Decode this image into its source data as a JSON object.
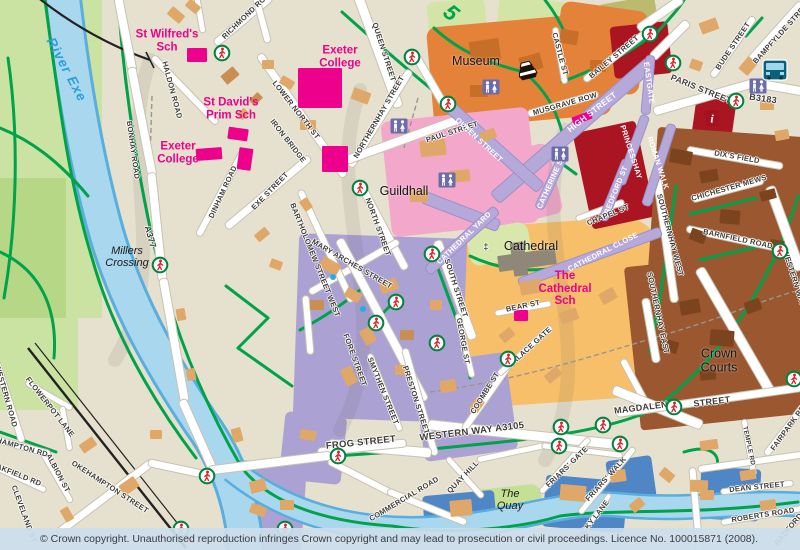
{
  "attribution": {
    "text": "© Crown copyright. Unauthorised reproduction infringes Crown copyright and may lead to prosecution or civil proceedings. Licence No. 100015871 (2008)."
  },
  "map": {
    "street_labels": [
      {
        "id": "queen-street-n",
        "text": "QUEEN STREET",
        "x": 384,
        "y": 52,
        "r": 72
      },
      {
        "id": "richmond-road",
        "text": "RICHMOND ROAD",
        "x": 248,
        "y": 14,
        "r": -44
      },
      {
        "id": "haldon-road",
        "text": "HALDON ROAD",
        "x": 172,
        "y": 90,
        "r": 75
      },
      {
        "id": "bonhay-road",
        "text": "BONHAY ROAD",
        "x": 133,
        "y": 150,
        "r": 82
      },
      {
        "id": "a377",
        "text": "A377",
        "x": 150,
        "y": 237,
        "r": 75,
        "s": 9
      },
      {
        "id": "lower-north-st",
        "text": "LOWER NORTH ST",
        "x": 296,
        "y": 110,
        "r": 52
      },
      {
        "id": "iron-bridge",
        "text": "IRON BRIDGE",
        "x": 288,
        "y": 141,
        "r": 52
      },
      {
        "id": "northernhay-street",
        "text": "NORTHERNHAY STREET",
        "x": 379,
        "y": 117,
        "r": -60
      },
      {
        "id": "paul-street",
        "text": "PAUL STREET",
        "x": 452,
        "y": 132,
        "r": -18
      },
      {
        "id": "queen-street-ped",
        "text": "QUEEN STREET",
        "x": 479,
        "y": 140,
        "r": 43,
        "v": "w"
      },
      {
        "id": "musgrave-row",
        "text": "MUSGRAVE ROW",
        "x": 565,
        "y": 104,
        "r": -16
      },
      {
        "id": "castle-st",
        "text": "CASTLE ST",
        "x": 560,
        "y": 54,
        "r": 75
      },
      {
        "id": "bailey-street",
        "text": "BAILEY STREET",
        "x": 614,
        "y": 57,
        "r": -40
      },
      {
        "id": "high-street",
        "text": "HIGH STREET",
        "x": 592,
        "y": 112,
        "r": -38,
        "v": "w",
        "s": 8.5
      },
      {
        "id": "eastgate",
        "text": "EASTGATE",
        "x": 649,
        "y": 83,
        "r": 82,
        "v": "w"
      },
      {
        "id": "princesshay",
        "text": "PRINCESSHAY",
        "x": 631,
        "y": 152,
        "r": 72,
        "v": "w"
      },
      {
        "id": "roman-walk",
        "text": "ROMAN WALK",
        "x": 658,
        "y": 163,
        "r": 72,
        "v": "w"
      },
      {
        "id": "catherine-st",
        "text": "CATHERINE ST",
        "x": 551,
        "y": 182,
        "r": -66,
        "v": "w"
      },
      {
        "id": "bedford-st",
        "text": "BEDFORD ST",
        "x": 616,
        "y": 190,
        "r": -68,
        "v": "w"
      },
      {
        "id": "chapel-st",
        "text": "CHAPEL ST",
        "x": 608,
        "y": 215,
        "r": -22
      },
      {
        "id": "paris-street",
        "text": "PARIS STREET",
        "x": 701,
        "y": 89,
        "r": 22,
        "s": 8.5
      },
      {
        "id": "b3183",
        "text": "B3183",
        "x": 763,
        "y": 99,
        "r": 8,
        "s": 9
      },
      {
        "id": "bude-street",
        "text": "BUDE STREET",
        "x": 733,
        "y": 46,
        "r": -56
      },
      {
        "id": "bampfylde-street",
        "text": "BAMPFYLDE STREET",
        "x": 782,
        "y": 32,
        "r": -48
      },
      {
        "id": "dixs-field",
        "text": "DIX'S FIELD",
        "x": 737,
        "y": 157,
        "r": 10
      },
      {
        "id": "chichester-mews",
        "text": "CHICHESTER MEWS",
        "x": 729,
        "y": 188,
        "r": -16
      },
      {
        "id": "barnfield-road",
        "text": "BARNFIELD ROAD",
        "x": 738,
        "y": 239,
        "r": 12
      },
      {
        "id": "southernhay-west",
        "text": "SOUTHERNHAY WEST",
        "x": 670,
        "y": 235,
        "r": 75
      },
      {
        "id": "southernhay-east",
        "text": "SOUTHERNHAY EAST",
        "x": 658,
        "y": 313,
        "r": 78
      },
      {
        "id": "cathedral-yard",
        "text": "CATHEDRAL YARD",
        "x": 464,
        "y": 238,
        "r": -44,
        "v": "w"
      },
      {
        "id": "cathedral-close",
        "text": "CATHEDRAL CLOSE",
        "x": 603,
        "y": 252,
        "r": -27,
        "v": "w"
      },
      {
        "id": "north-street",
        "text": "NORTH STREET",
        "x": 378,
        "y": 227,
        "r": 70
      },
      {
        "id": "mary-arches-street",
        "text": "MARY ARCHES STREET",
        "x": 352,
        "y": 264,
        "r": 30
      },
      {
        "id": "bartholomew-street-west",
        "text": "BARTHOLOMEW STREET WEST",
        "x": 315,
        "y": 260,
        "r": 68
      },
      {
        "id": "south-street",
        "text": "SOUTH STREET",
        "x": 456,
        "y": 288,
        "r": 72
      },
      {
        "id": "george-st",
        "text": "GEORGE ST",
        "x": 463,
        "y": 341,
        "r": 80
      },
      {
        "id": "fore-street",
        "text": "FORE STREET",
        "x": 355,
        "y": 360,
        "r": 70
      },
      {
        "id": "smythen-street",
        "text": "SMYTHEN STREET",
        "x": 383,
        "y": 391,
        "r": 68
      },
      {
        "id": "preston-street",
        "text": "PRESTON STREET",
        "x": 416,
        "y": 400,
        "r": 72
      },
      {
        "id": "exe-street",
        "text": "EXE STREET",
        "x": 270,
        "y": 191,
        "r": -46
      },
      {
        "id": "dinham-road",
        "text": "DINHAM ROAD",
        "x": 223,
        "y": 192,
        "r": -65
      },
      {
        "id": "bear-st",
        "text": "BEAR ST",
        "x": 523,
        "y": 306,
        "r": -12
      },
      {
        "id": "palace-gate",
        "text": "PALACE GATE",
        "x": 530,
        "y": 347,
        "r": -42
      },
      {
        "id": "coombe-st",
        "text": "COOMBE ST",
        "x": 485,
        "y": 393,
        "r": -58
      },
      {
        "id": "western-way-a3105",
        "text": "WESTERN WAY A3105",
        "x": 472,
        "y": 432,
        "r": -7,
        "s": 9.5
      },
      {
        "id": "frog-street",
        "text": "FROG STREET",
        "x": 361,
        "y": 443,
        "r": -6,
        "s": 9.5
      },
      {
        "id": "commercial-road",
        "text": "COMMERCIAL ROAD",
        "x": 404,
        "y": 499,
        "r": -31
      },
      {
        "id": "quay-hill",
        "text": "QUAY HILL",
        "x": 463,
        "y": 477,
        "r": -46
      },
      {
        "id": "magdalen",
        "text": "MAGDALEN",
        "x": 641,
        "y": 408,
        "r": -7,
        "s": 9
      },
      {
        "id": "magdalen-street-2",
        "text": "STREET",
        "x": 712,
        "y": 402,
        "r": -7,
        "s": 9
      },
      {
        "id": "temple-rd",
        "text": "TEMPLE RD",
        "x": 748,
        "y": 446,
        "r": 78,
        "s": 6.5
      },
      {
        "id": "fairpark-rd",
        "text": "FAIRPARK RD",
        "x": 788,
        "y": 428,
        "r": -54
      },
      {
        "id": "dean-street",
        "text": "DEAN STREET",
        "x": 757,
        "y": 487,
        "r": -6
      },
      {
        "id": "roberts-road",
        "text": "ROBERTS ROAD",
        "x": 763,
        "y": 515,
        "r": -9
      },
      {
        "id": "radford-rd",
        "text": "RADFORD RD",
        "x": 793,
        "y": 524,
        "r": -50
      },
      {
        "id": "friars-gate",
        "text": "FRIARS' GATE",
        "x": 567,
        "y": 467,
        "r": -44
      },
      {
        "id": "friars-walk",
        "text": "FRIARS' WALK",
        "x": 606,
        "y": 479,
        "r": -48
      },
      {
        "id": "lucky-lane",
        "text": "LUCKY LANE",
        "x": 592,
        "y": 521,
        "r": -52
      },
      {
        "id": "okehampton-street",
        "text": "OKEHAMPTON STREET",
        "x": 110,
        "y": 487,
        "r": 33
      },
      {
        "id": "flowerpot-lane",
        "text": "FLOWERPOT LANE",
        "x": 50,
        "y": 407,
        "r": 52
      },
      {
        "id": "albion-st",
        "text": "ALBION ST",
        "x": 58,
        "y": 473,
        "r": 62
      },
      {
        "id": "oakfield-rd",
        "text": "OAKFIELD RD",
        "x": 16,
        "y": 474,
        "r": 22
      },
      {
        "id": "okehampton-rd",
        "text": "OKEHAMPTON RD",
        "x": 14,
        "y": 445,
        "r": 16
      },
      {
        "id": "western-road",
        "text": "WESTERN ROAD",
        "x": 6,
        "y": 396,
        "r": 74
      },
      {
        "id": "cleveland-st",
        "text": "CLEVELAND ST",
        "x": 24,
        "y": 514,
        "r": 70
      },
      {
        "id": "western-way-n",
        "text": "WESTERN WAY",
        "x": 794,
        "y": 278,
        "r": 72
      },
      {
        "id": "cathedral-symbol",
        "text": "‡",
        "x": 486,
        "y": 247,
        "r": 0,
        "s": 9
      },
      {
        "id": "cycle-route-5",
        "text": "5",
        "x": 451,
        "y": 13,
        "r": 40,
        "v": "g",
        "s": 22
      }
    ],
    "poi_labels": [
      {
        "id": "river-exe",
        "text": "River Exe",
        "x": 66,
        "y": 70,
        "r": 62,
        "v": "water"
      },
      {
        "id": "millers-crossing",
        "text": "Millers\nCrossing",
        "x": 127,
        "y": 257,
        "r": 0,
        "v": "italic"
      },
      {
        "id": "the-quay",
        "text": "The\nQuay",
        "x": 510,
        "y": 500,
        "r": 0,
        "v": "italic"
      },
      {
        "id": "st-wilfreds-sch",
        "text": "St Wilfred's\nSch",
        "x": 167,
        "y": 41,
        "r": 0,
        "v": "school"
      },
      {
        "id": "st-davids-prim-sch",
        "text": "St David's\nPrim Sch",
        "x": 231,
        "y": 109,
        "r": 0,
        "v": "school"
      },
      {
        "id": "exeter-college-west",
        "text": "Exeter\nCollege",
        "x": 178,
        "y": 153,
        "r": 0,
        "v": "school"
      },
      {
        "id": "exeter-college-north",
        "text": "Exeter\nCollege",
        "x": 340,
        "y": 57,
        "r": 0,
        "v": "school"
      },
      {
        "id": "the-cathedral-sch",
        "text": "The\nCathedral\nSch",
        "x": 565,
        "y": 289,
        "r": 0,
        "v": "school"
      },
      {
        "id": "museum",
        "text": "Museum",
        "x": 476,
        "y": 62,
        "r": 0,
        "v": "black"
      },
      {
        "id": "guildhall",
        "text": "Guildhall",
        "x": 404,
        "y": 192,
        "r": 0,
        "v": "black"
      },
      {
        "id": "cathedral",
        "text": "Cathedral",
        "x": 531,
        "y": 247,
        "r": 0,
        "v": "black"
      },
      {
        "id": "crown-courts",
        "text": "Crown\nCourts",
        "x": 719,
        "y": 361,
        "r": 0,
        "v": "black"
      }
    ],
    "icons": [
      {
        "t": "crossing",
        "x": 222,
        "y": 53
      },
      {
        "t": "crossing",
        "x": 412,
        "y": 57
      },
      {
        "t": "crossing",
        "x": 448,
        "y": 104
      },
      {
        "t": "crossing",
        "x": 650,
        "y": 34
      },
      {
        "t": "crossing",
        "x": 673,
        "y": 63
      },
      {
        "t": "crossing",
        "x": 736,
        "y": 101
      },
      {
        "t": "crossing",
        "x": 160,
        "y": 265
      },
      {
        "t": "crossing",
        "x": 360,
        "y": 188
      },
      {
        "t": "crossing",
        "x": 432,
        "y": 254
      },
      {
        "t": "crossing",
        "x": 396,
        "y": 302
      },
      {
        "t": "crossing",
        "x": 376,
        "y": 323
      },
      {
        "t": "crossing",
        "x": 437,
        "y": 343
      },
      {
        "t": "crossing",
        "x": 508,
        "y": 359
      },
      {
        "t": "crossing",
        "x": 338,
        "y": 456
      },
      {
        "t": "crossing",
        "x": 207,
        "y": 476
      },
      {
        "t": "crossing",
        "x": 181,
        "y": 529
      },
      {
        "t": "crossing",
        "x": 285,
        "y": 529
      },
      {
        "t": "crossing",
        "x": 561,
        "y": 427
      },
      {
        "t": "crossing",
        "x": 603,
        "y": 425
      },
      {
        "t": "crossing",
        "x": 559,
        "y": 446
      },
      {
        "t": "crossing",
        "x": 620,
        "y": 444
      },
      {
        "t": "crossing",
        "x": 674,
        "y": 407
      },
      {
        "t": "crossing",
        "x": 780,
        "y": 251
      },
      {
        "t": "crossing",
        "x": 794,
        "y": 379
      },
      {
        "t": "toilets",
        "x": 399,
        "y": 126
      },
      {
        "t": "toilets",
        "x": 491,
        "y": 87
      },
      {
        "t": "toilets",
        "x": 447,
        "y": 180
      },
      {
        "t": "toilets",
        "x": 560,
        "y": 154
      },
      {
        "t": "toilets",
        "x": 758,
        "y": 86
      },
      {
        "t": "bus",
        "x": 775,
        "y": 70
      },
      {
        "t": "info",
        "x": 712,
        "y": 118,
        "label": "i"
      },
      {
        "t": "museum",
        "x": 527,
        "y": 70
      },
      {
        "t": "bluedot",
        "x": 333,
        "y": 277
      },
      {
        "t": "bluedot",
        "x": 363,
        "y": 309
      }
    ]
  }
}
